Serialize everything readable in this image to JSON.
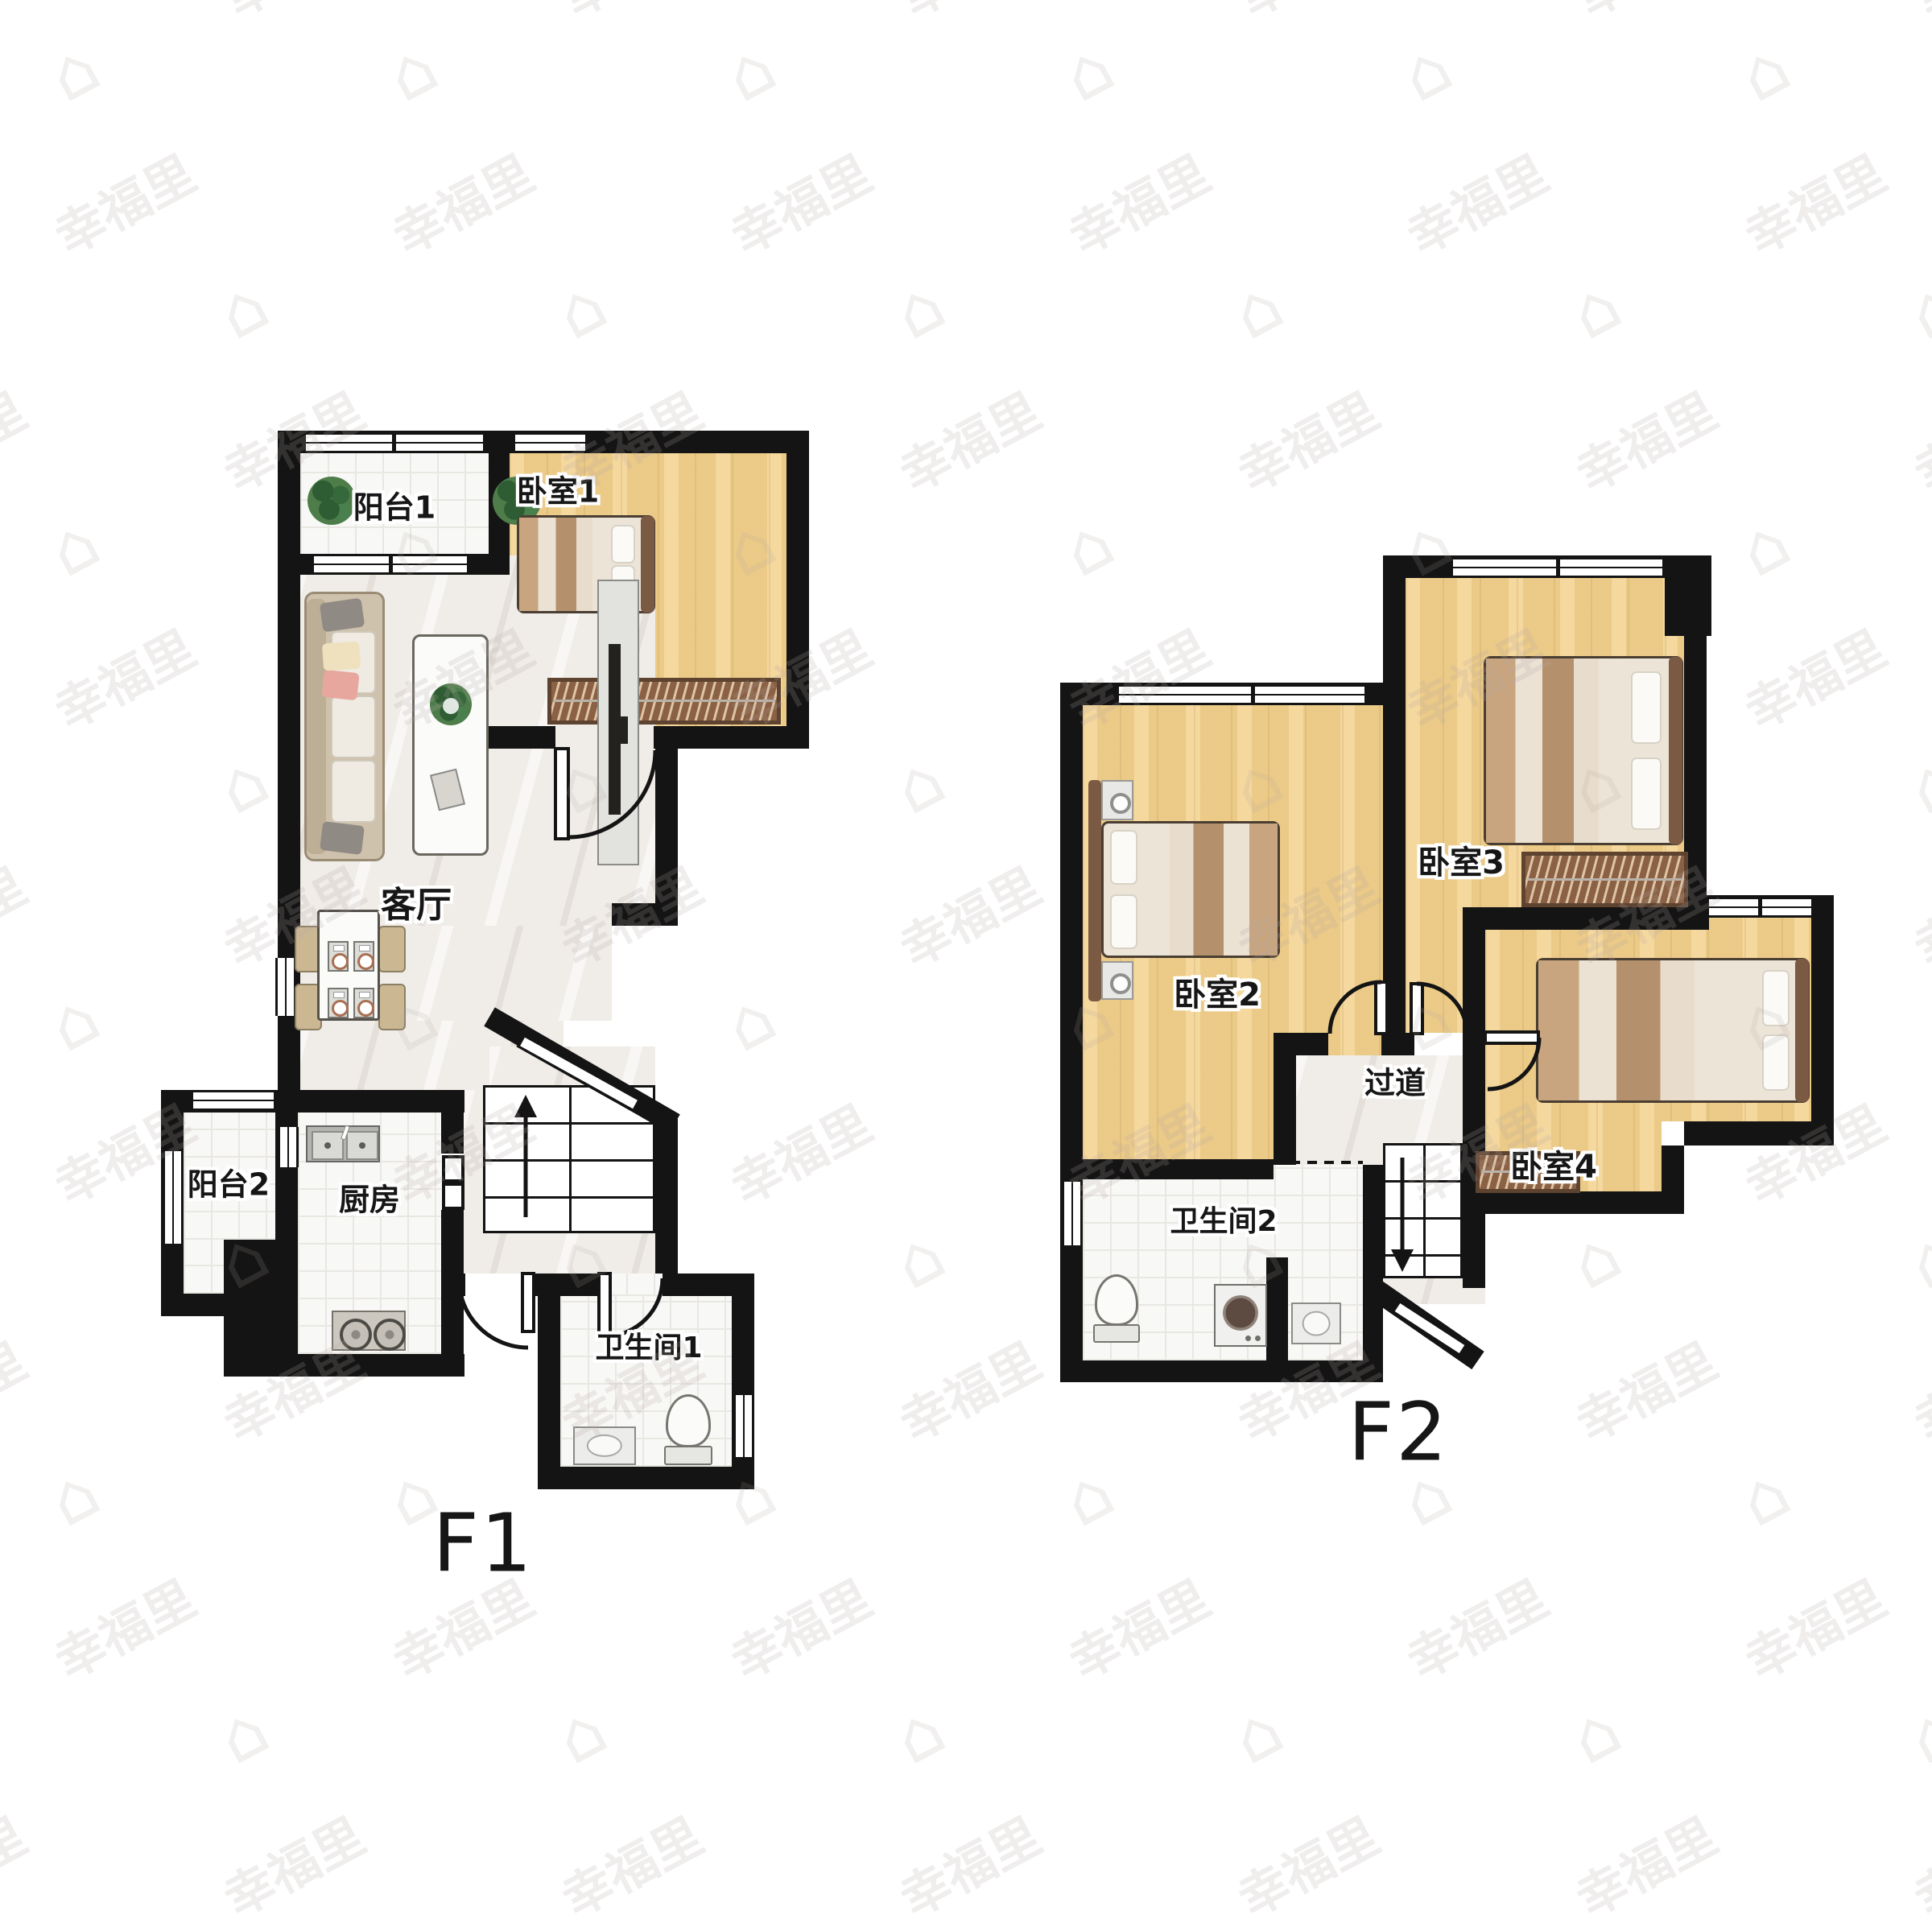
{
  "watermark": {
    "text": "幸福里",
    "house_icon": "⌂"
  },
  "floors": [
    {
      "label": "F1",
      "rooms": [
        {
          "name": "阳台1"
        },
        {
          "name": "卧室1"
        },
        {
          "name": "客厅"
        },
        {
          "name": "阳台2"
        },
        {
          "name": "厨房"
        },
        {
          "name": "卫生间1"
        }
      ]
    },
    {
      "label": "F2",
      "rooms": [
        {
          "name": "卧室2"
        },
        {
          "name": "卧室3"
        },
        {
          "name": "过道"
        },
        {
          "name": "卧室4"
        },
        {
          "name": "卫生间2"
        }
      ]
    }
  ],
  "stairs": {
    "f1_direction": "up",
    "f2_direction": "down"
  },
  "colors": {
    "wall": "#141414",
    "wood_floor": "#F3D18C",
    "tile_floor": "#F8F8F6",
    "marble_floor": "#F0EDE8",
    "wardrobe": "#8A6144",
    "plant_green": "#4E7D4A"
  }
}
